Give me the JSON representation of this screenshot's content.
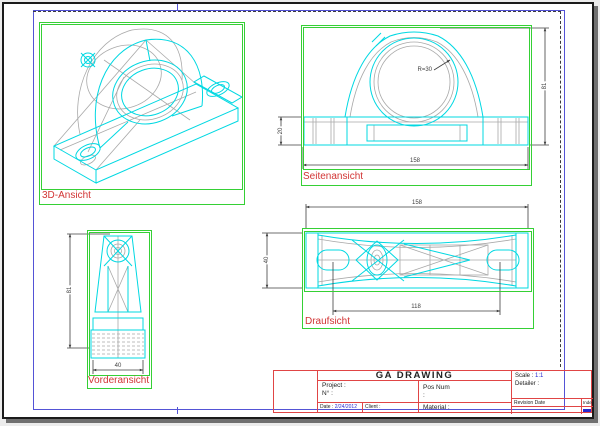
{
  "colors": {
    "frame_blue": "#5353d6",
    "viewport_green": "#35d035",
    "label_red": "#d23535",
    "geometry_cyan": "#00d8e2",
    "hidden_gray": "#a9a9a9",
    "dimension_gray": "#3f3f3f",
    "titleblock_red": "#e04545",
    "value_blue": "#2828d0"
  },
  "views": {
    "iso": {
      "label": "3D-Ansicht"
    },
    "side": {
      "label": "Seitenansicht",
      "dim_width": "158",
      "dim_height": "81",
      "dim_base": "20",
      "dim_radius": "R=30"
    },
    "front": {
      "label": "Vorderansicht",
      "dim_height": "81",
      "dim_width": "40"
    },
    "top": {
      "label": "Draufsicht",
      "dim_width": "158",
      "dim_holes": "118",
      "dim_depth": "40"
    }
  },
  "title_block": {
    "title": "GA DRAWING",
    "project_label": "Project :",
    "no_label": "N° :",
    "pos_num_label": "Pos Num",
    "pos_num_value": ":",
    "material_label": "Material :",
    "date_label": "Date :",
    "date_value": "2/24/2012",
    "client_label": "Client :",
    "scale_label": "Scale :",
    "scale_value": "1:1",
    "detailer_label": "Detailer :",
    "revision_label": "Revision Date",
    "index_label": "Index"
  }
}
